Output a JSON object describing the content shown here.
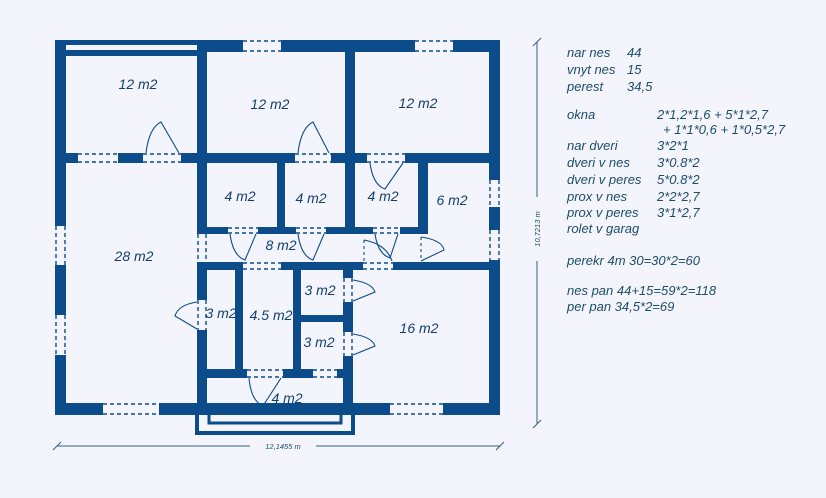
{
  "plan": {
    "rooms": [
      {
        "name": "garage",
        "label": "12 m2"
      },
      {
        "name": "room-top-middle",
        "label": "12 m2"
      },
      {
        "name": "room-top-right",
        "label": "12 m2"
      },
      {
        "name": "room-4-a",
        "label": "4 m2"
      },
      {
        "name": "room-4-b",
        "label": "4 m2"
      },
      {
        "name": "room-4-c",
        "label": "4 m2"
      },
      {
        "name": "room-6",
        "label": "6 m2"
      },
      {
        "name": "corridor",
        "label": "8 m2"
      },
      {
        "name": "living-room",
        "label": "28 m2"
      },
      {
        "name": "room-3-left",
        "label": "3 m2"
      },
      {
        "name": "room-4-5",
        "label": "4.5 m2"
      },
      {
        "name": "room-3-top-right",
        "label": "3 m2"
      },
      {
        "name": "room-3-bottom-right",
        "label": "3 m2"
      },
      {
        "name": "room-16",
        "label": "16 m2"
      },
      {
        "name": "vestibule",
        "label": "4 m2"
      }
    ],
    "dimensions": {
      "width": "12,1455 m",
      "height": "10,7213 m"
    }
  },
  "notes": {
    "areas": [
      {
        "label": "nar nes",
        "value": "44"
      },
      {
        "label": "vnyt nes",
        "value": "15"
      },
      {
        "label": "perest",
        "value": "34,5"
      }
    ],
    "openings": [
      {
        "label": "okna",
        "value": "2*1,2*1,6 + 5*1*2,7"
      },
      {
        "label": "",
        "value": "+ 1*1*0,6 + 1*0,5*2,7"
      },
      {
        "label": "nar dveri",
        "value": "3*2*1"
      },
      {
        "label": "dveri v nes",
        "value": "3*0.8*2"
      },
      {
        "label": "dveri v peres",
        "value": "5*0.8*2"
      },
      {
        "label": "prox v nes",
        "value": "2*2*2,7"
      },
      {
        "label": "prox v peres",
        "value": "3*1*2,7"
      },
      {
        "label": "rolet v garag",
        "value": ""
      }
    ],
    "calculations": [
      "perekr 4m  30=30*2=60",
      "nes pan 44+15=59*2=118",
      "per pan 34,5*2=69"
    ]
  },
  "colors": {
    "wall": "#0c4c8a",
    "background": "#f4f5fc",
    "notes_text": "#1c4d66",
    "room_text": "#133f6e"
  }
}
